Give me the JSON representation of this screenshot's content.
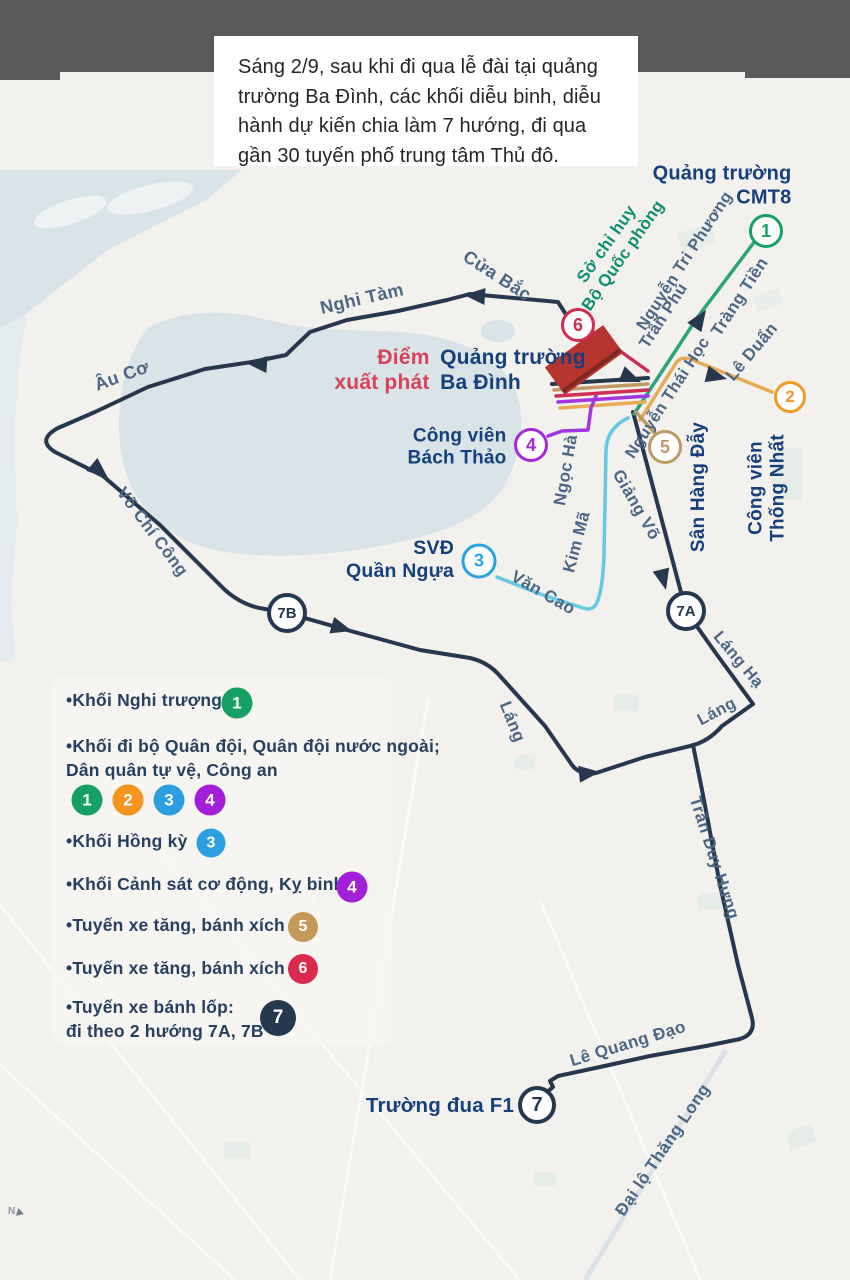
{
  "header": {
    "text": "Sáng 2/9, sau khi đi qua lễ đài tại quảng trường Ba Đình, các khối diễu binh, diễu hành dự kiến chia làm 7 hướng, đi qua gần 30 tuyến phố trung tâm Thủ đô."
  },
  "map": {
    "places": {
      "cmt8_line1": "Quảng trường",
      "cmt8_line2": "CMT8",
      "hq_line1": "Sở chỉ huy",
      "hq_line2": "Bộ Quốc phòng",
      "start_line1": "Điểm",
      "start_line2": "xuất phát",
      "badinh_line1": "Quảng trường",
      "badinh_line2": "Ba Đình",
      "bachthao_line1": "Công viên",
      "bachthao_line2": "Bách Thảo",
      "svd_line1": "SVĐ",
      "svd_line2": "Quần Ngựa",
      "thongnhat_line1": "Công viên",
      "thongnhat_line2": "Thống Nhất",
      "hangday": "Sân Hàng Đẫy",
      "f1": "Trường đua F1"
    },
    "streets": {
      "cua_bac": "Cửa Bắc",
      "nghi_tam": "Nghi Tàm",
      "au_co": "Âu Cơ",
      "vo_chi_cong": "Võ Chí Công",
      "ngoc_ha": "Ngọc Hà",
      "van_cao": "Văn Cao",
      "kim_ma": "Kim Mã",
      "giang_vo": "Giảng Võ",
      "nguyen_thai_hoc": "Nguyễn Thái Học",
      "tran_phu": "Trần Phú",
      "nguyen_tri_phuong": "Nguyễn Tri Phương",
      "trang_tien": "Tràng Tiền",
      "le_duan": "Lê Duẩn",
      "lang_ha": "Láng Hạ",
      "lang_1": "Láng",
      "lang_2": "Láng",
      "tran_duy_hung": "Trần Duy Hưng",
      "le_quang_dao": "Lê Quang Đạo",
      "dai_lo_thang_long": "Đại lộ Thăng Long"
    },
    "badges": {
      "b1": "1",
      "b2": "2",
      "b3": "3",
      "b4": "4",
      "b5": "5",
      "b6": "6",
      "b7": "7",
      "b7a": "7A",
      "b7b": "7B"
    },
    "compass": "N"
  },
  "legend": {
    "item1": "•Khối Nghi trượng",
    "item1_badge": "1",
    "item2_line1": "•Khối đi bộ Quân đội, Quân đội nước ngoài;",
    "item2_line2": "Dân quân tự vệ, Công an",
    "item2_badges": {
      "b1": "1",
      "b2": "2",
      "b3": "3",
      "b4": "4"
    },
    "item3": "•Khối Hồng kỳ",
    "item3_badge": "3",
    "item4": "•Khối Cảnh sát cơ động, Kỵ binh",
    "item4_badge": "4",
    "item5": "•Tuyến xe tăng, bánh xích",
    "item5_badge": "5",
    "item6": "•Tuyến xe tăng, bánh xích",
    "item6_badge": "6",
    "item7_line1": "•Tuyến xe bánh lốp:",
    "item7_line2": "đi theo 2 hướng 7A, 7B",
    "item7_badge": "7"
  },
  "colors": {
    "route_navy": "#26374e",
    "route_green": "#2aa478",
    "route_orange": "#e8ab55",
    "route_blue": "#66c9e6",
    "route_purple": "#a335e0",
    "route_tan": "#c09a66",
    "route_crimson": "#ce2f55",
    "water": "#d9e4e8",
    "water_light": "#e3ebee",
    "park_patch": "#e4ebe7",
    "square_red": "#b5342e",
    "badge_green": "#17a065",
    "badge_orange": "#f5941f",
    "badge_blue": "#2d9fe0",
    "badge_purple": "#a31fd8",
    "badge_tan": "#c49a58",
    "badge_crimson": "#da2b4e",
    "badge_navy": "#253850"
  }
}
